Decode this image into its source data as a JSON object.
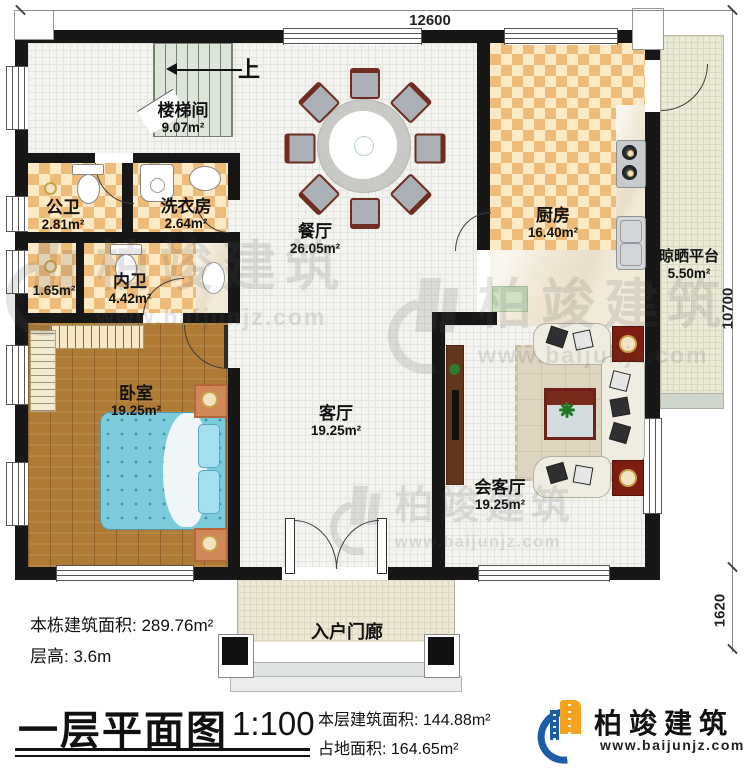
{
  "dimensions": {
    "top": "12600",
    "right": "10700",
    "right_bottom": "1620"
  },
  "stairs": {
    "up_label": "上"
  },
  "rooms": {
    "stairwell": {
      "name": "楼梯间",
      "area": "9.07m²"
    },
    "public_bath": {
      "name": "公卫",
      "area": "2.81m²"
    },
    "laundry": {
      "name": "洗衣房",
      "area": "2.64m²"
    },
    "closet": {
      "area": "1.65m²"
    },
    "private_bath": {
      "name": "内卫",
      "area": "4.42m²"
    },
    "bedroom": {
      "name": "卧室",
      "area": "19.25m²"
    },
    "dining": {
      "name": "餐厅",
      "area": "26.05m²"
    },
    "kitchen": {
      "name": "厨房",
      "area": "16.40m²"
    },
    "platform": {
      "name": "晾晒平台",
      "area": "5.50m²"
    },
    "living": {
      "name": "客厅",
      "area": "19.25m²"
    },
    "reception": {
      "name": "会客厅",
      "area": "19.25m²"
    },
    "porch": {
      "name": "入户门廊"
    }
  },
  "info": {
    "building_total": "本栋建筑面积: 289.76m²",
    "floor_height": "层高: 3.6m",
    "floor_area": "本层建筑面积: 144.88m²",
    "land_area": "占地面积: 164.65m²"
  },
  "titleblock": {
    "title": "一层平面图",
    "scale": "1:100"
  },
  "logo": {
    "name": "柏竣建筑",
    "url": "www.baijunjz.com",
    "blue": "#1d5da7",
    "orange": "#f6a21c"
  },
  "watermark": {
    "text": "柏竣建筑",
    "url": "www.baijunjz.com"
  }
}
